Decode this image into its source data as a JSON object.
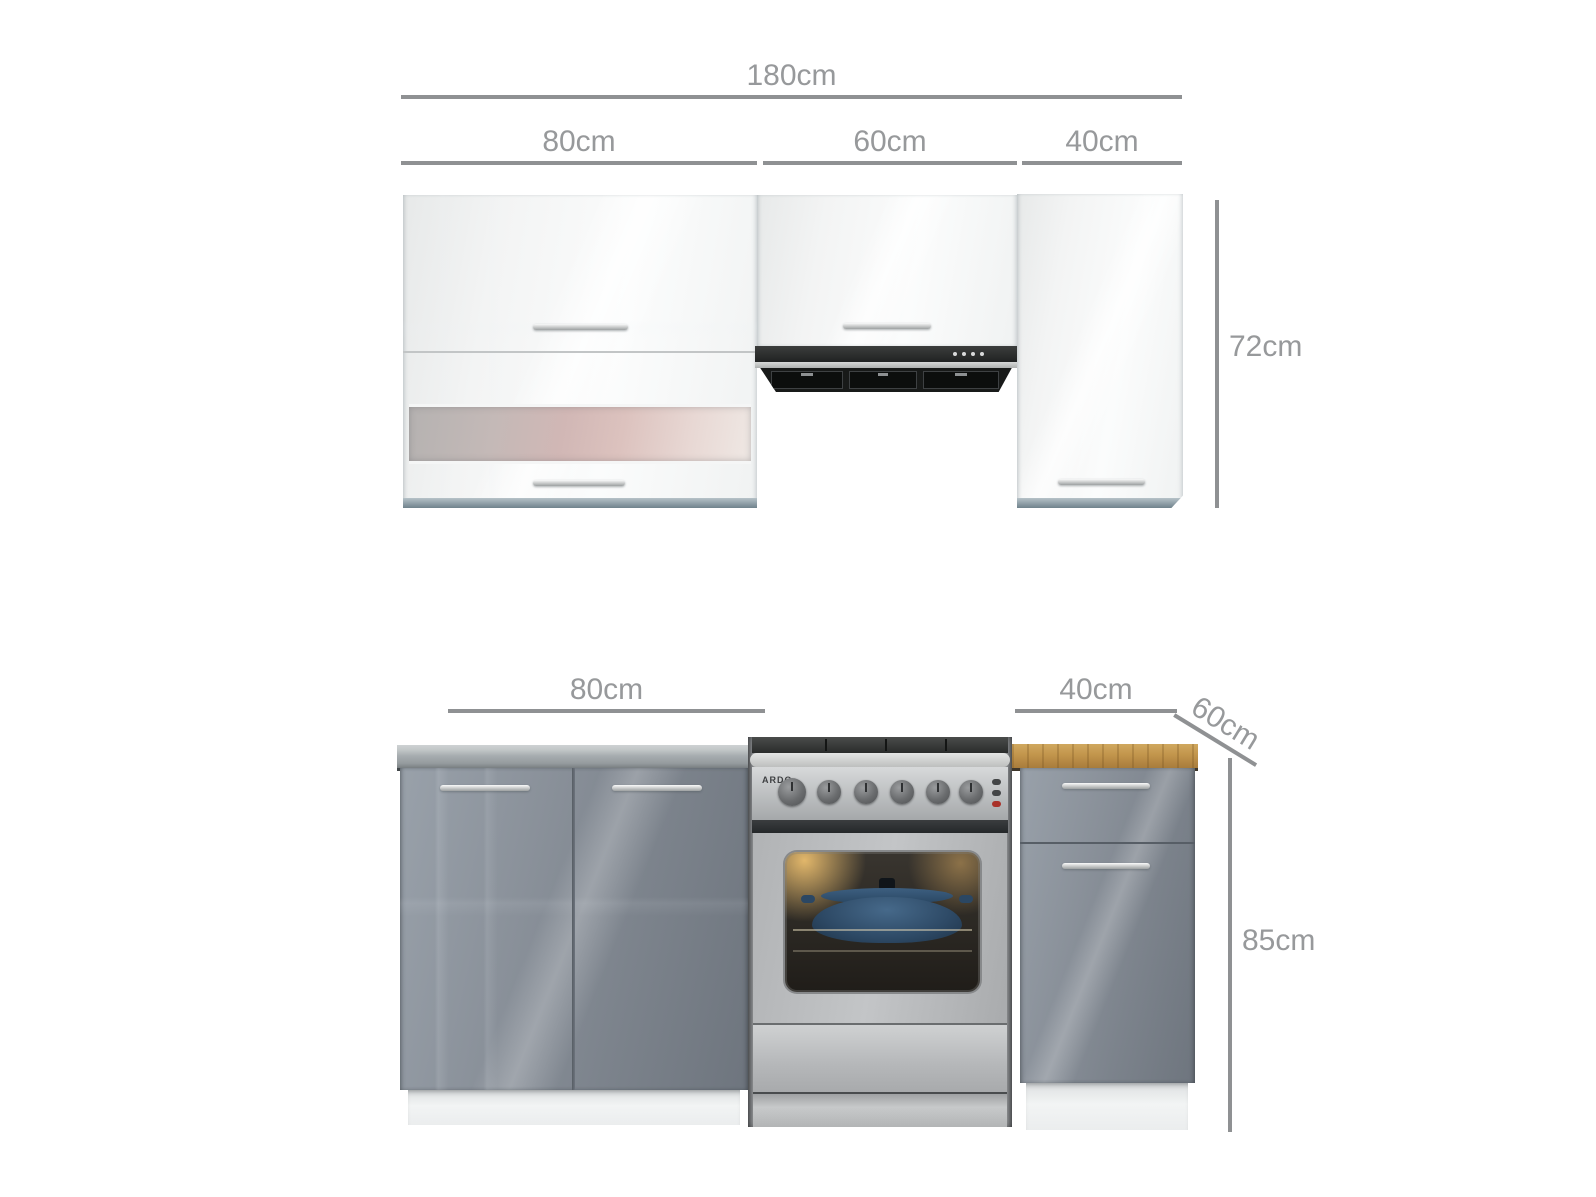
{
  "upper": {
    "total_width_label": "180cm",
    "segment_labels": {
      "cab80": "80cm",
      "cab60": "60cm",
      "cab40": "40cm"
    },
    "height_label": "72cm"
  },
  "lower": {
    "cab80_label": "80cm",
    "cab40_label": "40cm",
    "depth_label": "60cm",
    "height_label": "85cm"
  },
  "cooker": {
    "brand": "ARDO"
  },
  "colors": {
    "dimension_text": "#97999b",
    "dimension_line": "#8f9193",
    "cabinet_white_gloss": "#f3f4f4",
    "cabinet_grey_gloss": "#848b93",
    "glass_band_pink": "#d6bcb9",
    "hood_black": "#222424",
    "worktop_steel": "#a9afb2",
    "worktop_wood": "#bd8f4a",
    "cooker_steel": "#b7b9bb",
    "oven_pot_blue": "#31506b",
    "indicator_red": "#a93129",
    "plinth_white": "#eff1f1"
  }
}
